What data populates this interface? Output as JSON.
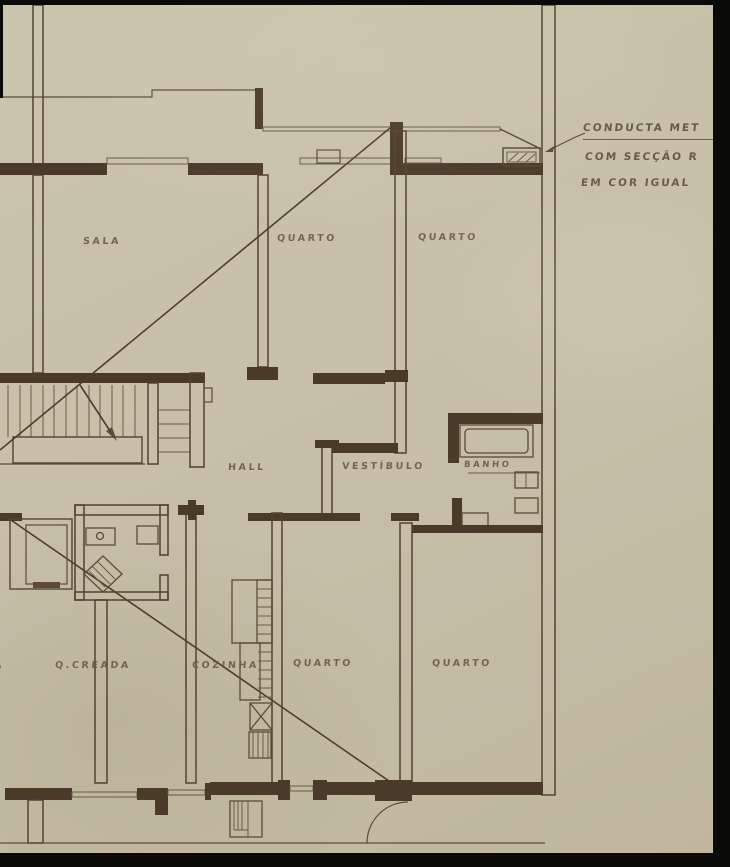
{
  "document": {
    "type": "scanned architectural floor plan",
    "language": "Portuguese",
    "description": "Hand-drawn apartment floor plan on aged paper with dark scanner edges"
  },
  "colors": {
    "paper": "#c8c0a9",
    "paper_shadow": "#bfb69d",
    "ink_line": "#5d4b38",
    "ink_wall": "#4a3a29",
    "ink_label": "#6b5847",
    "scan_edge_black": "#0a0a09"
  },
  "labels": {
    "sala": "SALA",
    "quarto_top_1": "QUARTO",
    "quarto_top_2": "QUARTO",
    "hall": "HALL",
    "vestibulo": "VESTÍBULO",
    "banho": "BANHO",
    "creada": "Q.CREADA",
    "cozinha": "COZINHA",
    "quarto_bottom_1": "QUARTO",
    "quarto_bottom_2": "QUARTO",
    "edge_partial": "A"
  },
  "annotation": {
    "line1": "CONDUCTA MET",
    "line2": "COM SECÇÃO R",
    "line3": "EM COR IGUAL"
  }
}
